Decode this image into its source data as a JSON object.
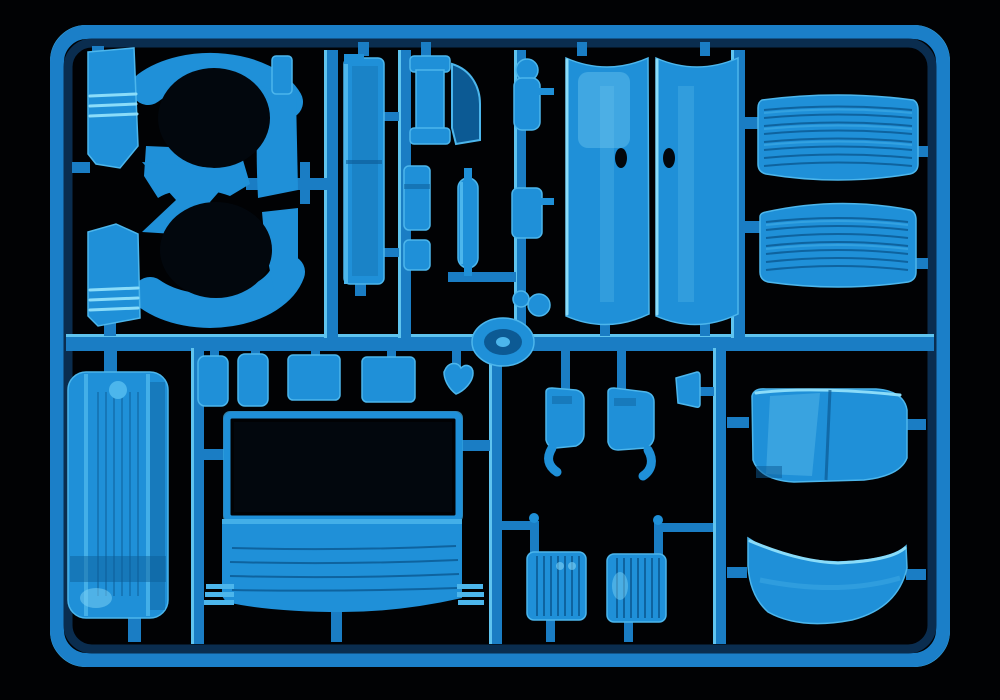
{
  "scene": {
    "subject": "Injection-molded plastic model kit sprue with light blue truck cab parts on a black background",
    "frame": "rounded rectangular runner frame with internal runner bars",
    "parts": [
      {
        "id": "fender-upper",
        "label": "wheel-arch fender, upper left"
      },
      {
        "id": "fender-lower",
        "label": "wheel-arch fender, lower left (mirrored)"
      },
      {
        "id": "side-panel",
        "label": "tall narrow cab side panel"
      },
      {
        "id": "spool-panel",
        "label": "flanged spool-shaped panel with shadowed side wall"
      },
      {
        "id": "small-bracket-a",
        "label": "small notched bracket"
      },
      {
        "id": "small-bracket-b",
        "label": "small bracket"
      },
      {
        "id": "exhaust-capsule",
        "label": "capsule-shaped pipe part"
      },
      {
        "id": "mirror-arm",
        "label": "mirror arm on parts chain"
      },
      {
        "id": "chain-mid-part",
        "label": "small block on parts chain"
      },
      {
        "id": "chain-knobs",
        "label": "round knobs on parts chain"
      },
      {
        "id": "wheel-disc",
        "label": "round disc part at runner junction"
      },
      {
        "id": "door-left",
        "label": "cab door panel, left"
      },
      {
        "id": "door-right",
        "label": "cab door panel, right"
      },
      {
        "id": "grille-upper",
        "label": "ribbed grille panel, upper"
      },
      {
        "id": "grille-lower",
        "label": "ribbed grille panel, lower"
      },
      {
        "id": "fuel-tank",
        "label": "fuel tank with straps and filler cap"
      },
      {
        "id": "box-row",
        "label": "row of small storage boxes and clip"
      },
      {
        "id": "cab-front",
        "label": "cab front panel with dark windshield opening and grille grooves"
      },
      {
        "id": "bracket-left",
        "label": "mudflap bracket with curved tail, left"
      },
      {
        "id": "bracket-right",
        "label": "mudflap bracket with curved tail, right"
      },
      {
        "id": "wedge",
        "label": "small wedge part"
      },
      {
        "id": "step-left",
        "label": "ribbed entry step plate, left"
      },
      {
        "id": "step-right",
        "label": "ribbed entry step plate, right"
      },
      {
        "id": "roof-deflector",
        "label": "large curved roof wind deflector"
      },
      {
        "id": "front-spoiler",
        "label": "curved front spoiler / visor panel"
      }
    ]
  },
  "palette": {
    "bg": "#010204",
    "frameBright": "#45b3e8",
    "frameMid": "#1b7fc8",
    "frameDark": "#0a2d4f",
    "runner": "#1a7dc4",
    "runnerHi": "#5fc4ef",
    "part": "#1f90d8",
    "partBright": "#4cb6ec",
    "partEdge": "#8adcf9",
    "partDark": "#0c5a94",
    "recess": "#02070d",
    "groove": "#0e639f",
    "sheen": "#7fd4f6"
  }
}
